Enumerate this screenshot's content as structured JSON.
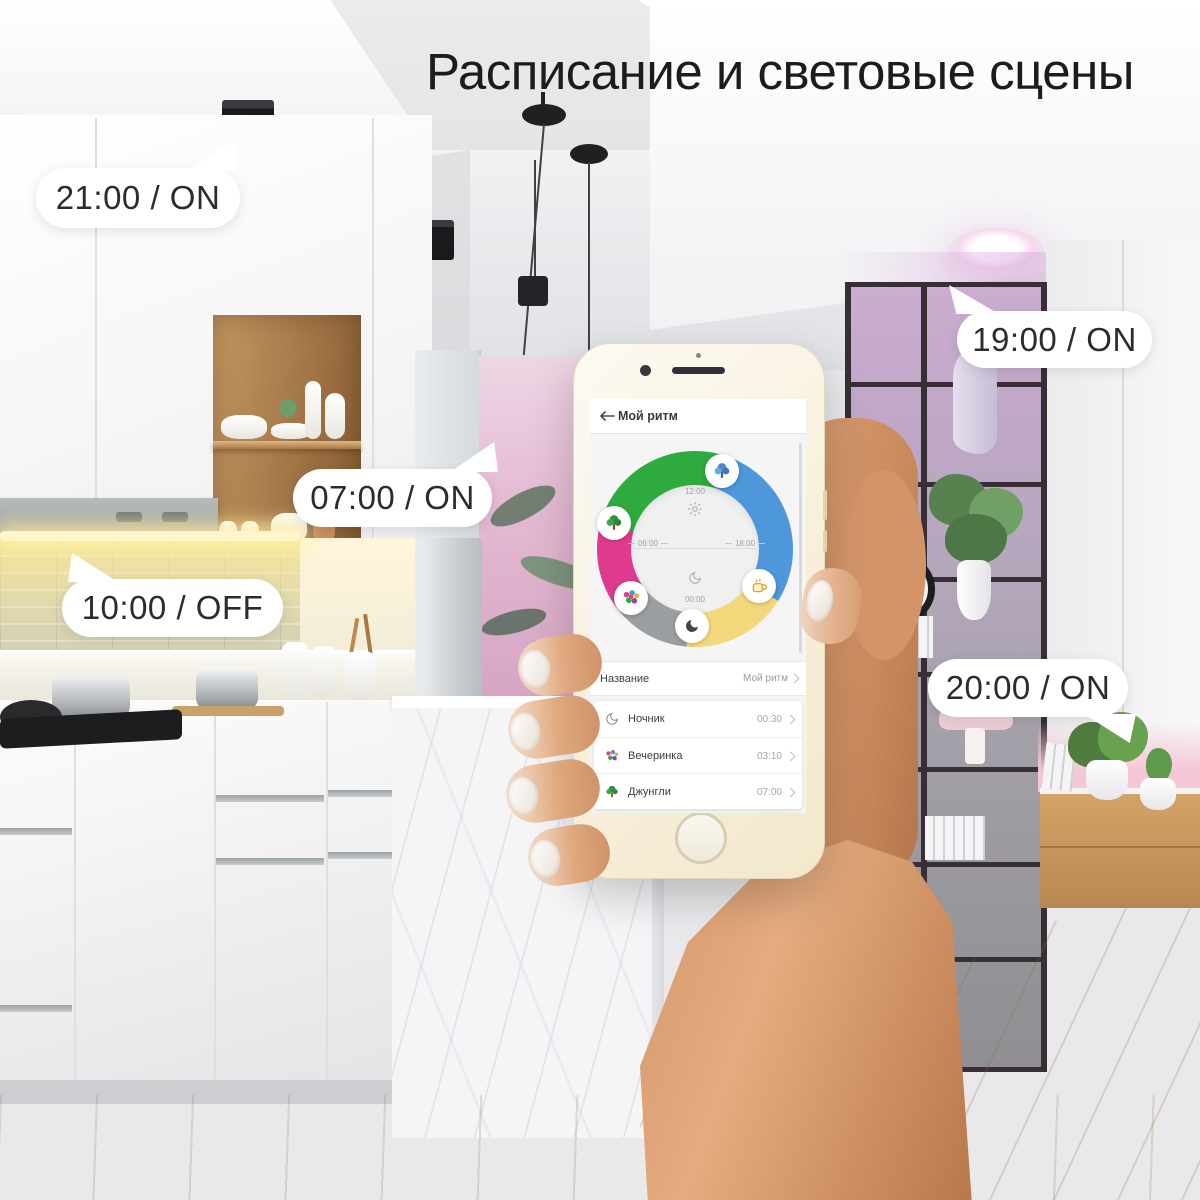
{
  "title": "Расписание и световые сцены",
  "callouts": [
    {
      "label": "21:00 / ON",
      "time": "21:00",
      "state": "ON"
    },
    {
      "label": "07:00 / ON",
      "time": "07:00",
      "state": "ON"
    },
    {
      "label": "10:00 / OFF",
      "time": "10:00",
      "state": "OFF"
    },
    {
      "label": "19:00 / ON",
      "time": "19:00",
      "state": "ON"
    },
    {
      "label": "20:00 / ON",
      "time": "20:00",
      "state": "ON"
    }
  ],
  "phone_app": {
    "header": {
      "title": "Мой ритм"
    },
    "rhythm_wheel": {
      "labels": {
        "noon": "12:00",
        "evening": "18:00",
        "midnight": "00:00",
        "morning": "06:00"
      },
      "segments": [
        {
          "name": "jungle",
          "color": "#2faa3e"
        },
        {
          "name": "day",
          "color": "#4e97da"
        },
        {
          "name": "morning",
          "color": "#f3d87b"
        },
        {
          "name": "night",
          "color": "#9b9fa1"
        },
        {
          "name": "party",
          "color": "#e03a8f"
        }
      ],
      "markers": [
        "blue-plant-icon",
        "jungle-tree-icon",
        "party-icon",
        "moon-icon",
        "mug-icon"
      ]
    },
    "name_row": {
      "label": "Название",
      "value": "Мой ритм"
    },
    "scenes": [
      {
        "name": "Ночник",
        "time": "00:30",
        "icon": "moon-icon"
      },
      {
        "name": "Вечеринка",
        "time": "03:10",
        "icon": "party-icon"
      },
      {
        "name": "Джунгли",
        "time": "07:00",
        "icon": "jungle-tree-icon"
      }
    ]
  }
}
